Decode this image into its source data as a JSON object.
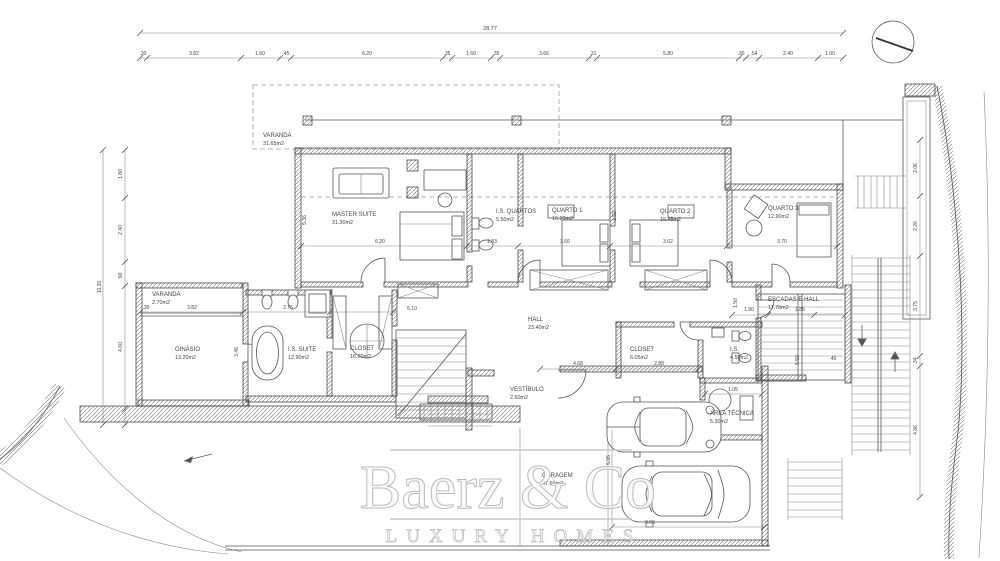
{
  "palette": {
    "line": "#444444",
    "wall_hatch": "#777777",
    "dashed": "#9a9a9a",
    "watermark": "#bdbdbd",
    "background": "#ffffff"
  },
  "watermark": {
    "title": "Baerz & Co",
    "subtitle": "LUXURY HOMES"
  },
  "dims": {
    "overall_top": "28.77",
    "top_segments": [
      ".30",
      "3.82",
      "1.60",
      ".45",
      "6.20",
      ".35",
      "1.60",
      ".35",
      "3.66",
      ".31",
      "5.80",
      ".30",
      ".54",
      "2.40",
      "1.00"
    ],
    "overall_left": "10.30",
    "left_segments": [
      "1.80",
      "2.40",
      ".90",
      "4.60"
    ],
    "right_segments": [
      "2.06",
      "2.26",
      "3.75",
      ".34",
      "4.86"
    ],
    "interior": [
      "6.20",
      "1.83",
      "3.66",
      "3.62",
      "3.70",
      "5.36",
      "1.52",
      "3.82",
      "2.75",
      "3.46",
      "5.10",
      "4.68",
      "2.88",
      "1.80",
      "1.85",
      "1.50",
      "1.05",
      "5.50",
      ".40",
      "5.95",
      "9.00",
      ".30"
    ]
  },
  "rooms": [
    {
      "name": "VARANDA",
      "area": "31.65m2"
    },
    {
      "name": "MASTER SUITE",
      "area": "31.30m2"
    },
    {
      "name": "I.S. QUARTOS",
      "area": "5.50m2"
    },
    {
      "name": "QUARTO 1",
      "area": "16.20m2"
    },
    {
      "name": "QUARTO 2",
      "area": "16.45m2"
    },
    {
      "name": "QUARTO 3",
      "area": "12.90m2"
    },
    {
      "name": "VARANDA",
      "area": "2.70m2"
    },
    {
      "name": "GINÁSIO",
      "area": "13.20m2"
    },
    {
      "name": "I.S. SUITE",
      "area": "12.90m2"
    },
    {
      "name": "CLOSET",
      "area": "16.20m2"
    },
    {
      "name": "HALL",
      "area": "23.40m2"
    },
    {
      "name": "VESTÍBULO",
      "area": "2.60m2"
    },
    {
      "name": "ESCADAS E HALL",
      "area": "11.70m2"
    },
    {
      "name": "CLOSET",
      "area": "6.05m2"
    },
    {
      "name": "I.S.",
      "area": "4.50m2"
    },
    {
      "name": "ÁREA TÉCNICA",
      "area": "5.30m2"
    },
    {
      "name": "GARAGEM",
      "area": "47.60m2"
    }
  ]
}
